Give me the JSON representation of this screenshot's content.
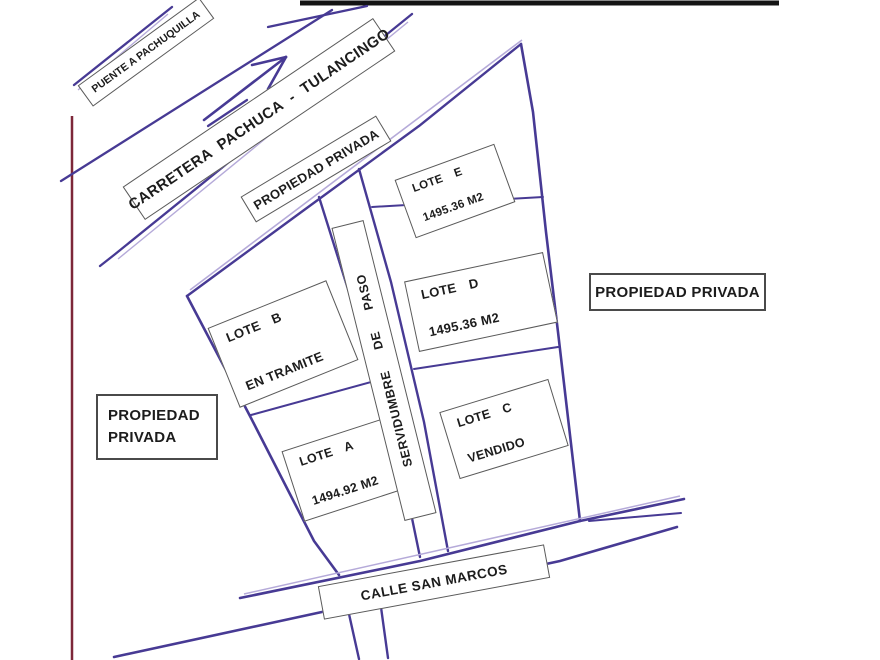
{
  "map": {
    "type": "hand-drawn land plat / location sketch",
    "labels": {
      "puente": "PUENTE A PACHUQUILLA",
      "carretera": "CARRETERA PACHUCA - TULANCINGO",
      "propiedad_top": "PROPIEDAD PRIVADA",
      "propiedad_right": "PROPIEDAD PRIVADA",
      "propiedad_left_line1": "PROPIEDAD",
      "propiedad_left_line2": "PRIVADA",
      "servidumbre": "SERVIDUMBRE DE PASO",
      "calle": "CALLE SAN MARCOS"
    },
    "lots": [
      {
        "id": "E",
        "name": "LOTE E",
        "detail": "1495.36 M2"
      },
      {
        "id": "D",
        "name": "LOTE D",
        "detail": "1495.36 M2"
      },
      {
        "id": "B",
        "name": "LOTE B",
        "detail": "EN TRAMITE"
      },
      {
        "id": "A",
        "name": "LOTE A",
        "detail": "1494.92 M2"
      },
      {
        "id": "C",
        "name": "LOTE C",
        "detail": "VENDIDO"
      }
    ],
    "colors": {
      "ink": "#473a94",
      "ink_light": "#b5aad9",
      "page_edge_maroon": "#7d2739",
      "top_border_black": "#141414",
      "box_border": "#5a5a5a",
      "text": "#1c1c1c",
      "background": "#ffffff"
    }
  }
}
